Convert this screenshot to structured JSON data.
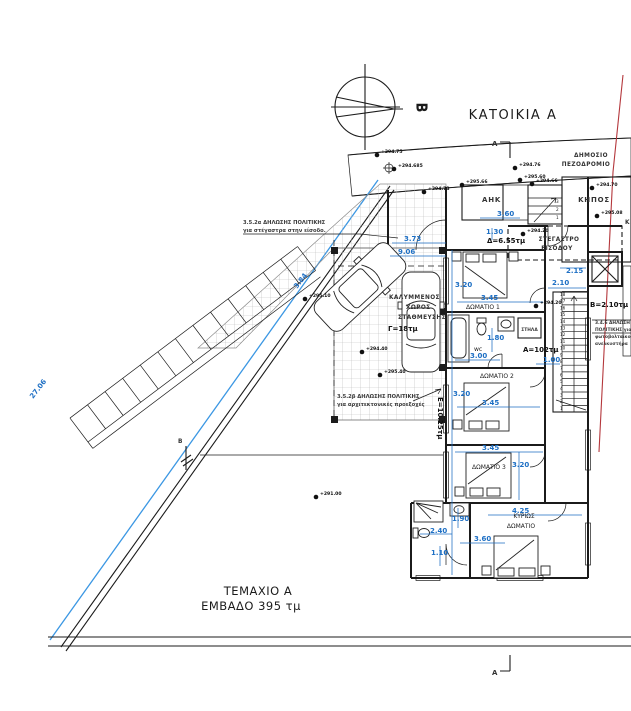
{
  "drawing": {
    "title": "ΚΑΤΟΙΚΙΑ Α",
    "plot_line1": "ΤΕΜΑΧΙΟ Α",
    "plot_line2": "ΕΜΒΑΔΟ 395 τμ",
    "north_letter": "Β"
  },
  "site": {
    "sidewalk_line1": "ΔΗΜΟΣΙΟ",
    "sidewalk_line2": "ΠΕΖΟΔΡΟΜΙΟ",
    "garden": "ΚΗΠΟΣ",
    "garden_partial": "Κ",
    "utility_box": "ΑΗΚ",
    "canopy_line1": "ΣΤΕΓΑΣΤΡΟ",
    "canopy_line2": "ΕΙΣΟΔΟΥ"
  },
  "rooms": {
    "bedroom1": "ΔΩΜΑΤΙΟ 1",
    "bedroom2": "ΔΩΜΑΤΙΟ 2",
    "bedroom3": "ΔΩΜΑΤΙΟ 3",
    "master_line1": "ΚΥΡΙΩΣ",
    "master_line2": "ΔΩΜΑΤΙΟ",
    "wc": "wc",
    "duct": "ΣΤΗΛΑ",
    "parking_line1": "ΚΑΛΥΜΜΕΝΟΣ",
    "parking_line2": "ΧΩΡΟΣ",
    "parking_line3": "ΣΤΑΘΜΕΥΣΗΣ"
  },
  "areas": {
    "house": "Α=102τμ",
    "balcony": "Β=2.10τμ",
    "parking": "Γ=18τμ",
    "canopy": "Δ=6.55τμ",
    "veranda": "Ε=10.25τμ"
  },
  "notes": {
    "a_line1": "3.5.2α ΔΗΛΩΣΗΣ ΠΟΛΙΤΙΚΗΣ",
    "a_line2": "για στέγαστρα στην είσοδο.",
    "b_line1": "3.5.2β ΔΗΛΩΣΗΣ ΠΟΛΙΤΙΚΗΣ",
    "b_line2": "για αρχιτεκτονικές προεξοχές",
    "c_line1": "3.4.6 ΔΗΛΩΣΗ",
    "c_line2": "ΠΟΛΙΤΙΚΗΣ για",
    "c_line3": "φωτοβολταϊκού",
    "c_line4": "ανελκυστήρα"
  },
  "section_markers": {
    "top": "A",
    "bottom": "A",
    "left": "Β"
  },
  "dimensions": [
    {
      "v": "3.73",
      "x": 404,
      "y": 241,
      "r": 0
    },
    {
      "v": "9.06",
      "x": 398,
      "y": 254,
      "r": 0
    },
    {
      "v": "3.84",
      "x": 297,
      "y": 289,
      "r": -52
    },
    {
      "v": "27.06",
      "x": 33,
      "y": 399,
      "r": -52
    },
    {
      "v": "3.60",
      "x": 497,
      "y": 216,
      "r": 0
    },
    {
      "v": "1.30",
      "x": 486,
      "y": 234,
      "r": 0
    },
    {
      "v": "2.15",
      "x": 566,
      "y": 273,
      "r": 0
    },
    {
      "v": "2.10",
      "x": 552,
      "y": 285,
      "r": 0
    },
    {
      "v": "3.20",
      "x": 455,
      "y": 287,
      "r": 0
    },
    {
      "v": "3.45",
      "x": 481,
      "y": 300,
      "r": 0
    },
    {
      "v": "1.80",
      "x": 487,
      "y": 340,
      "r": 0
    },
    {
      "v": "3.00",
      "x": 470,
      "y": 358,
      "r": 0
    },
    {
      "v": "1.00",
      "x": 543,
      "y": 362,
      "r": 0
    },
    {
      "v": "3.20",
      "x": 453,
      "y": 396,
      "r": 0
    },
    {
      "v": "3.45",
      "x": 482,
      "y": 405,
      "r": 0
    },
    {
      "v": "3.45",
      "x": 482,
      "y": 450,
      "r": 0
    },
    {
      "v": "3.20",
      "x": 512,
      "y": 467,
      "r": 0
    },
    {
      "v": "4.25",
      "x": 512,
      "y": 513,
      "r": 0
    },
    {
      "v": "1.90",
      "x": 452,
      "y": 521,
      "r": 0
    },
    {
      "v": "2.40",
      "x": 430,
      "y": 533,
      "r": 0
    },
    {
      "v": "3.60",
      "x": 474,
      "y": 541,
      "r": 0
    },
    {
      "v": "1.10",
      "x": 431,
      "y": 555,
      "r": 0
    }
  ],
  "elevations": [
    {
      "v": "+294.75",
      "x": 381,
      "y": 153
    },
    {
      "v": "+294.685",
      "x": 398,
      "y": 167
    },
    {
      "v": "+294.76",
      "x": 519,
      "y": 166
    },
    {
      "v": "+295.60",
      "x": 524,
      "y": 178
    },
    {
      "v": "+294.70",
      "x": 596,
      "y": 186
    },
    {
      "v": "+295.08",
      "x": 601,
      "y": 214
    },
    {
      "v": "+294.73",
      "x": 428,
      "y": 190
    },
    {
      "v": "+295.66",
      "x": 466,
      "y": 183
    },
    {
      "v": "+294.66",
      "x": 536,
      "y": 182
    },
    {
      "v": "+294.20",
      "x": 527,
      "y": 232
    },
    {
      "v": "+294.20",
      "x": 540,
      "y": 304
    },
    {
      "v": "+295.10",
      "x": 309,
      "y": 297
    },
    {
      "v": "+294.40",
      "x": 366,
      "y": 350
    },
    {
      "v": "+295.40",
      "x": 384,
      "y": 373
    },
    {
      "v": "+291.00",
      "x": 320,
      "y": 495
    }
  ],
  "stairs": {
    "numbers": [
      "18",
      "17",
      "16",
      "15",
      "14",
      "13",
      "12",
      "11",
      "10",
      "9",
      "8",
      "7",
      "6",
      "5",
      "4",
      "3",
      "2",
      "1"
    ],
    "x": 560,
    "y_top": 296,
    "step": 6.7
  },
  "entry_steps": {
    "numbers": [
      "3",
      "2",
      "1"
    ],
    "x": 556,
    "y_top": 203,
    "step": 8
  },
  "colors": {
    "dimension_blue": "#1d6fc4",
    "boundary_blue": "#3b97e3",
    "section_red": "#b4373c",
    "wall_black": "#1b1b1b",
    "grid_gray": "#9a9a9a",
    "garden_dot": "#4e7d6f"
  }
}
